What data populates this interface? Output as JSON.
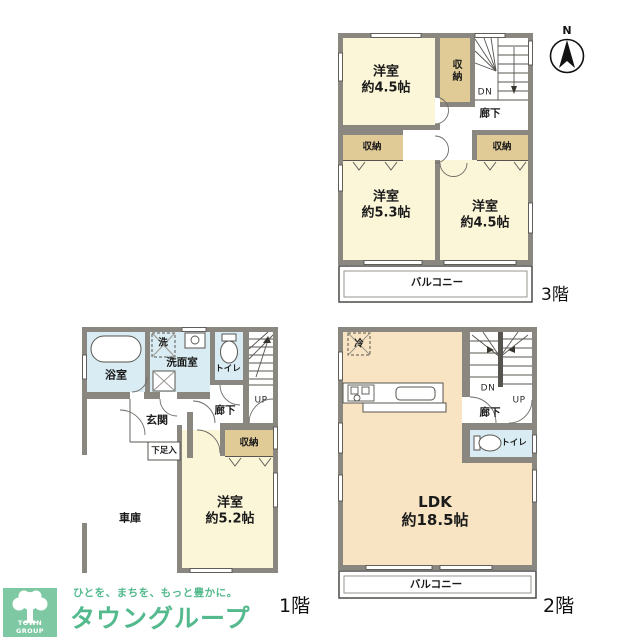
{
  "compass": {
    "north_label": "N"
  },
  "floor3": {
    "floor_label": "3階",
    "room_nw": {
      "name": "洋室",
      "size": "約4.5帖"
    },
    "room_sw": {
      "name": "洋室",
      "size": "約5.3帖"
    },
    "room_se": {
      "name": "洋室",
      "size": "約4.5帖"
    },
    "closet_top": "収納",
    "closet_left": "収納",
    "closet_right": "収納",
    "hallway": "廊下",
    "stair_down": "DN",
    "balcony": "バルコニー"
  },
  "floor1": {
    "floor_label": "1階",
    "bathroom": "浴室",
    "washer": "洗",
    "washroom": "洗面室",
    "toilet": "トイレ",
    "stair_up": "UP",
    "hallway": "廊下",
    "entrance": "玄関",
    "shoe_cabinet": "下足入",
    "closet": "収納",
    "room": {
      "name": "洋室",
      "size": "約5.2帖"
    },
    "garage": "車庫"
  },
  "floor2": {
    "floor_label": "2階",
    "refrigerator": "冷",
    "stair_down": "DN",
    "stair_up": "UP",
    "hallway": "廊下",
    "toilet": "トイレ",
    "ldk": {
      "name": "LDK",
      "size": "約18.5帖"
    },
    "balcony": "バルコニー"
  },
  "logo": {
    "company_en": "TOWN GROUP",
    "tagline": "ひとを、まちを、もっと豊かに。",
    "company_jp": "タウングループ"
  },
  "colors": {
    "wall_gray": "#8a8680",
    "room_cream": "#fcf6d9",
    "ldk_peach": "#f8e4c2",
    "closet_tan": "#e0ca95",
    "water_blue": "#d9ecf3",
    "logo_green": "#7fc8a4",
    "logo_text_green": "#54ba8e"
  }
}
